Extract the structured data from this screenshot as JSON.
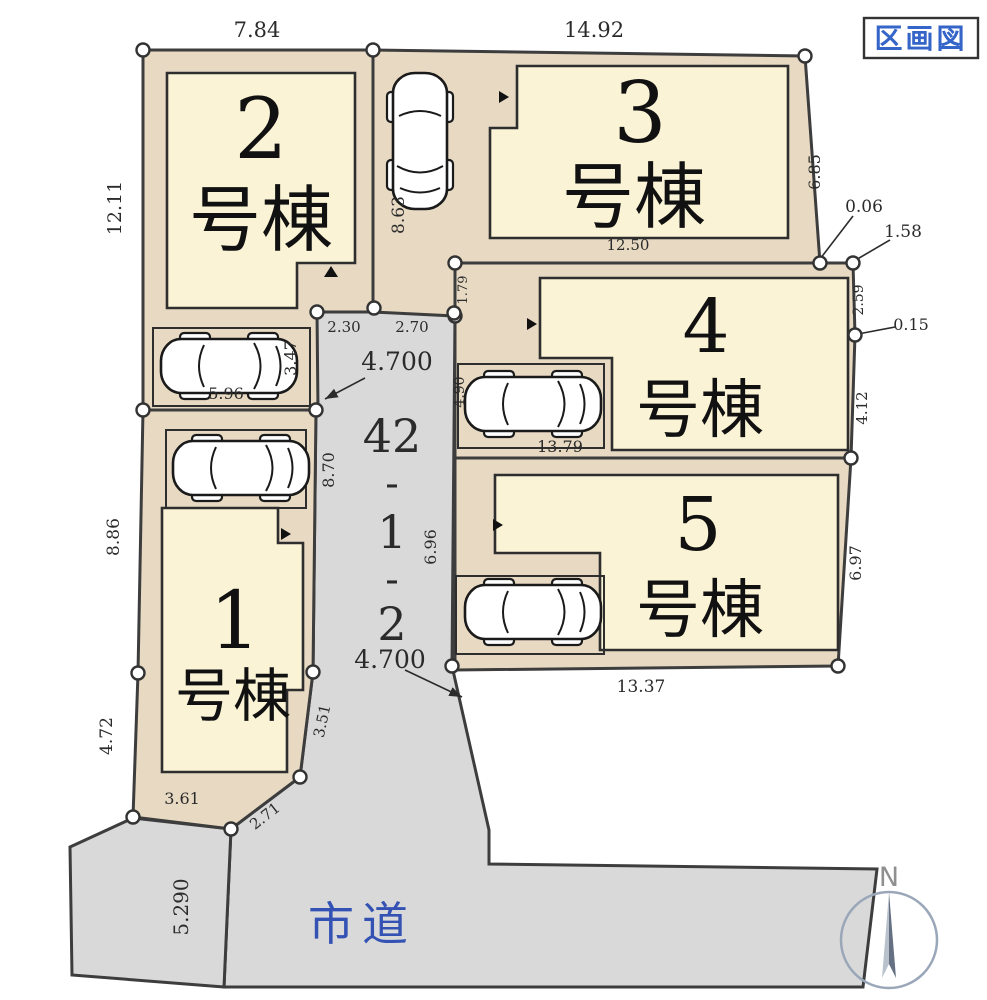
{
  "title": "区画図",
  "compass_label": "N",
  "road_label": "市道",
  "center_lot": {
    "l1": "42",
    "l2": "-",
    "l3": "1",
    "l4": "-",
    "l5": "2"
  },
  "lots": {
    "lot1": {
      "number": "1",
      "suffix": "号棟"
    },
    "lot2": {
      "number": "2",
      "suffix": "号棟"
    },
    "lot3": {
      "number": "3",
      "suffix": "号棟"
    },
    "lot4": {
      "number": "4",
      "suffix": "号棟"
    },
    "lot5": {
      "number": "5",
      "suffix": "号棟"
    }
  },
  "dims": {
    "top_lot2": "7.84",
    "top_lot3": "14.92",
    "left_lot2": "12.11",
    "drive_top": "8.63",
    "right_lot3": "6.85",
    "offset_006": "0.06",
    "offset_158": "1.58",
    "bottom_lot3": "12.50",
    "left_lot4_a": "1.79",
    "drive_seg_a": "2.30",
    "drive_seg_b": "2.70",
    "drive_width_top": "4.700",
    "parking_side": "3.47",
    "parking_width": "5.96",
    "left_lot4_b": "4.90",
    "bottom_lot4": "13.79",
    "right_lot4_a": "2.59",
    "offset_015": "0.15",
    "right_lot4_b": "4.12",
    "left_lot1_a": "8.86",
    "drive_left": "8.70",
    "drive_right": "6.96",
    "right_lot5": "6.97",
    "bottom_lot5": "13.37",
    "drive_width_bottom": "4.700",
    "left_lot1_b": "4.72",
    "bottom_lot1": "3.61",
    "corner_lot1": "2.71",
    "right_lot1": "3.51",
    "road_left": "5.290"
  },
  "colors": {
    "parcel": "#e7d9c2",
    "building": "#fbf3d6",
    "road_gray": "#d9d9d9",
    "outline": "#3d3d3d",
    "blue_text": "#3565c8",
    "road_text": "#3452b4",
    "compass_gray": "#9aa7b8"
  }
}
